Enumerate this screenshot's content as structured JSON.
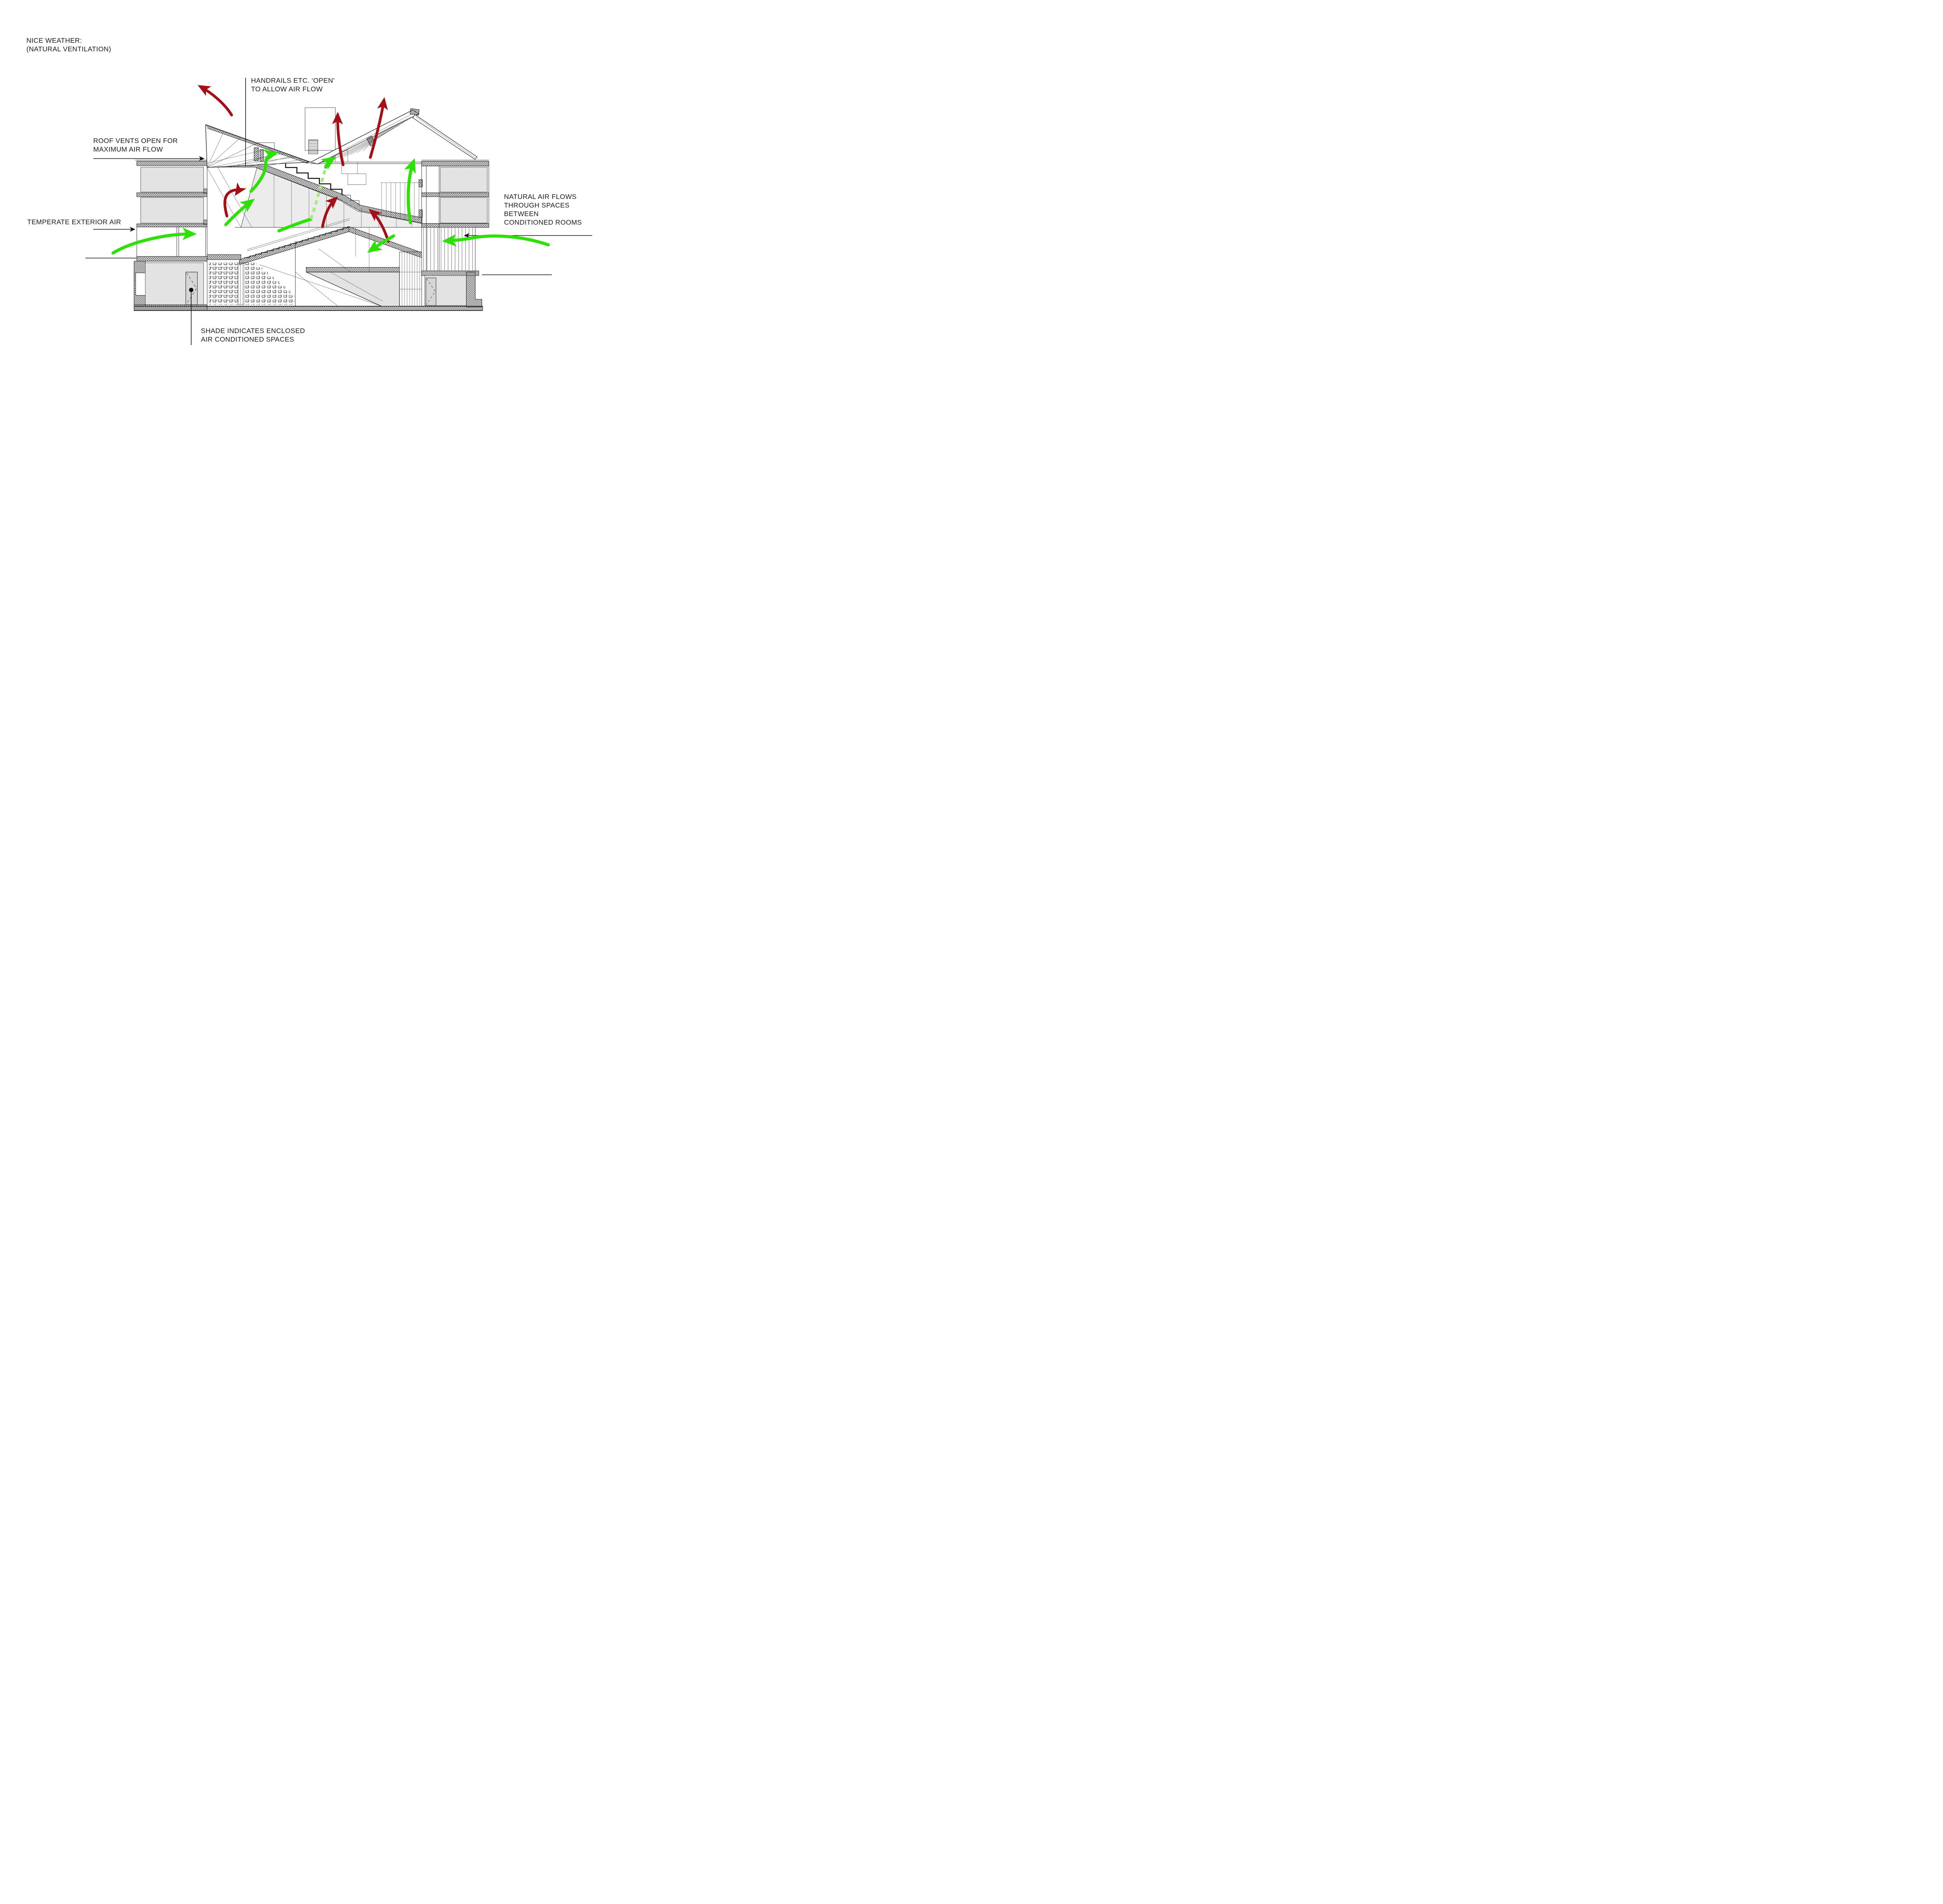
{
  "title": {
    "line1": "NICE WEATHER:",
    "line2": "(NATURAL VENTILATION)"
  },
  "annotations": {
    "handrails": {
      "line1": "HANDRAILS ETC. ‘OPEN’",
      "line2": "TO ALLOW AIR FLOW"
    },
    "roof_vents": {
      "line1": "ROOF VENTS OPEN FOR",
      "line2": "MAXIMUM AIR FLOW"
    },
    "temperate_air": {
      "line1": "TEMPERATE EXTERIOR AIR"
    },
    "natural_flow": {
      "line1": "NATURAL AIR FLOWS",
      "line2": "THROUGH SPACES",
      "line3": "BETWEEN",
      "line4": "CONDITIONED ROOMS"
    },
    "shade": {
      "line1": "SHADE INDICATES ENCLOSED",
      "line2": "AIR CONDITIONED SPACES"
    }
  },
  "colors": {
    "background": "#ffffff",
    "ink": "#1a1a1a",
    "line": "#2b2b2b",
    "room_shade": "#e3e3e3",
    "exhaust_air": "#a50f15",
    "fresh_air": "#2ce204",
    "fresh_air_dashed": "#a9e87f"
  }
}
